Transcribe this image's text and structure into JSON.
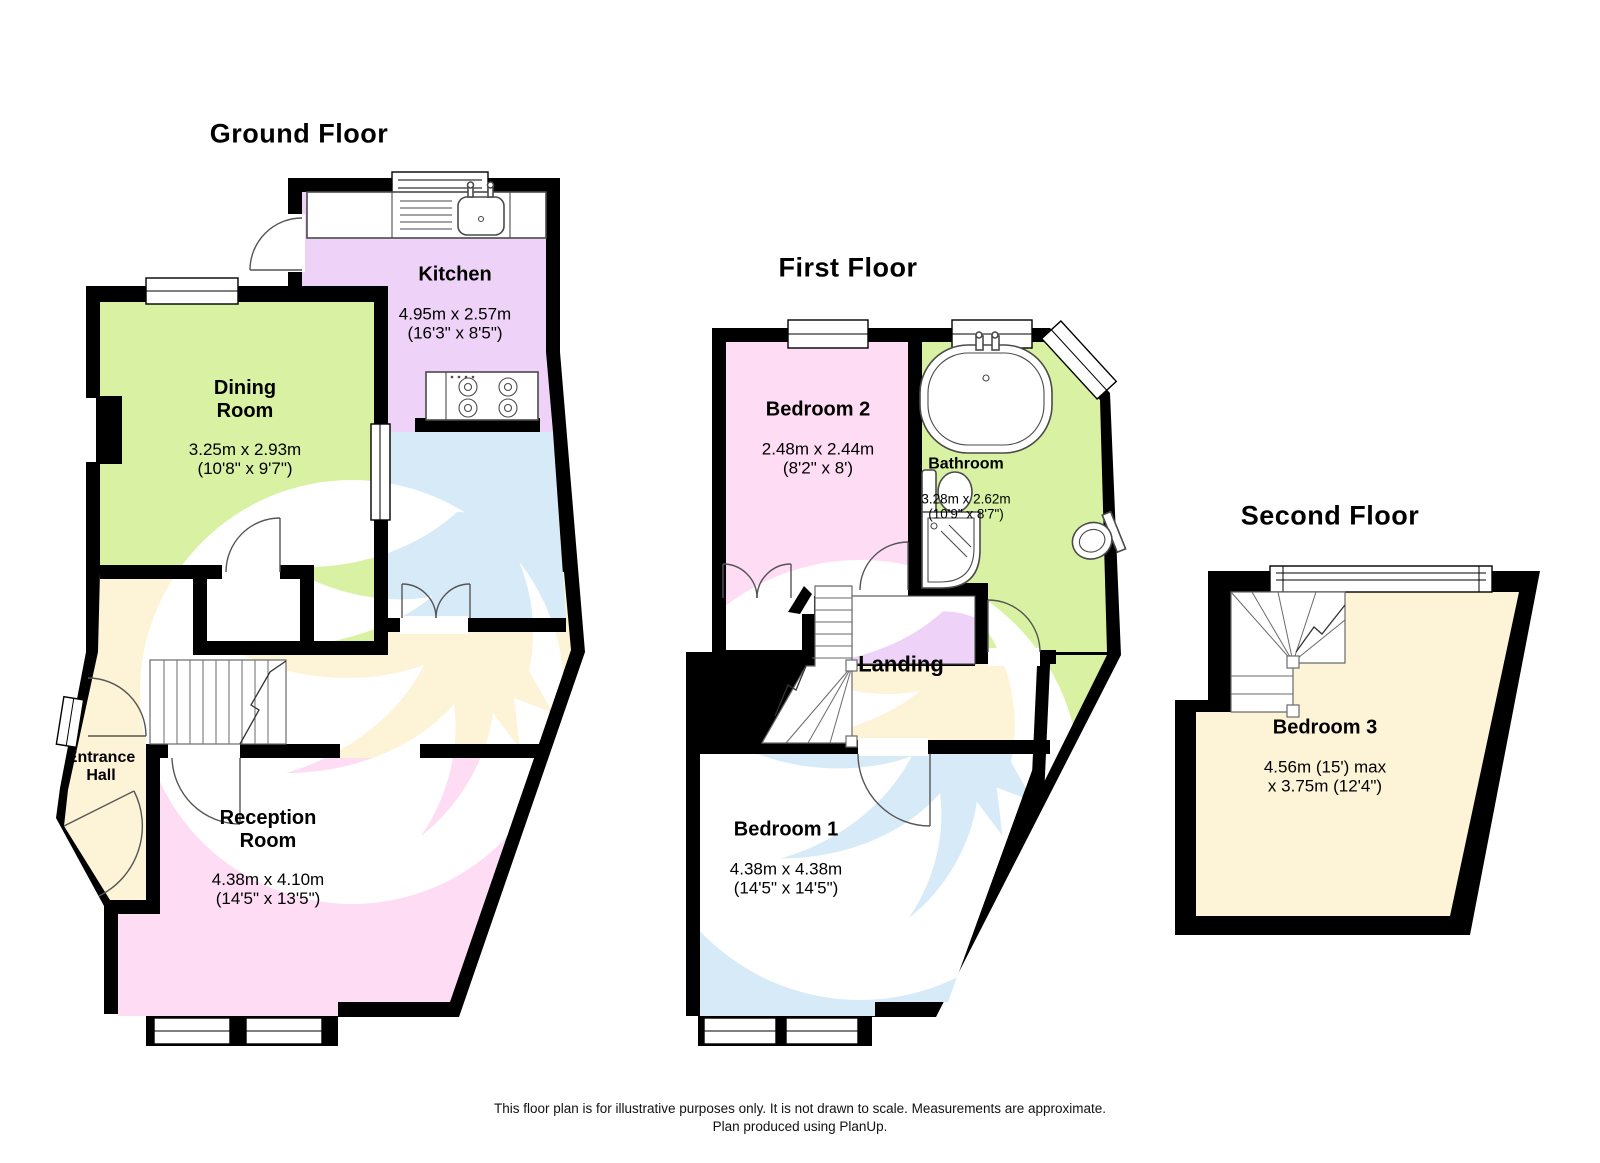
{
  "palette": {
    "wall": "#000000",
    "green": "#d9f1a2",
    "lavender": "#eed2f7",
    "blue": "#d7eaf8",
    "pink": "#fddcf4",
    "cream": "#fdf3d7",
    "bird_tan": "#f7e4ba",
    "watermark_white": "#ffffff"
  },
  "floors": {
    "ground": {
      "title": "Ground Floor",
      "rooms": {
        "kitchen": {
          "name": "Kitchen",
          "dims": "4.95m x 2.57m\n(16'3\" x 8'5\")"
        },
        "dining": {
          "name": "Dining\nRoom",
          "dims": "3.25m x 2.93m\n(10'8\" x 9'7\")"
        },
        "hall": {
          "name": "Entrance\nHall",
          "dims": ""
        },
        "reception": {
          "name": "Reception\nRoom",
          "dims": "4.38m x 4.10m\n(14'5\" x 13'5\")"
        }
      }
    },
    "first": {
      "title": "First Floor",
      "rooms": {
        "bedroom2": {
          "name": "Bedroom 2",
          "dims": "2.48m x 2.44m\n(8'2\" x 8')"
        },
        "bathroom": {
          "name": "Bathroom",
          "dims": "3.28m x 2.62m\n(10'9\" x 8'7\")"
        },
        "landing": {
          "name": "Landing",
          "dims": ""
        },
        "bedroom1": {
          "name": "Bedroom 1",
          "dims": "4.38m x 4.38m\n(14'5\" x 14'5\")"
        }
      }
    },
    "second": {
      "title": "Second Floor",
      "rooms": {
        "bedroom3": {
          "name": "Bedroom 3",
          "dims": "4.56m (15') max\nx 3.75m (12'4\")"
        }
      }
    }
  },
  "footer": {
    "line1": "This floor plan is for illustrative purposes only. It is not drawn to scale. Measurements are approximate.",
    "line2": "Plan produced using PlanUp."
  }
}
